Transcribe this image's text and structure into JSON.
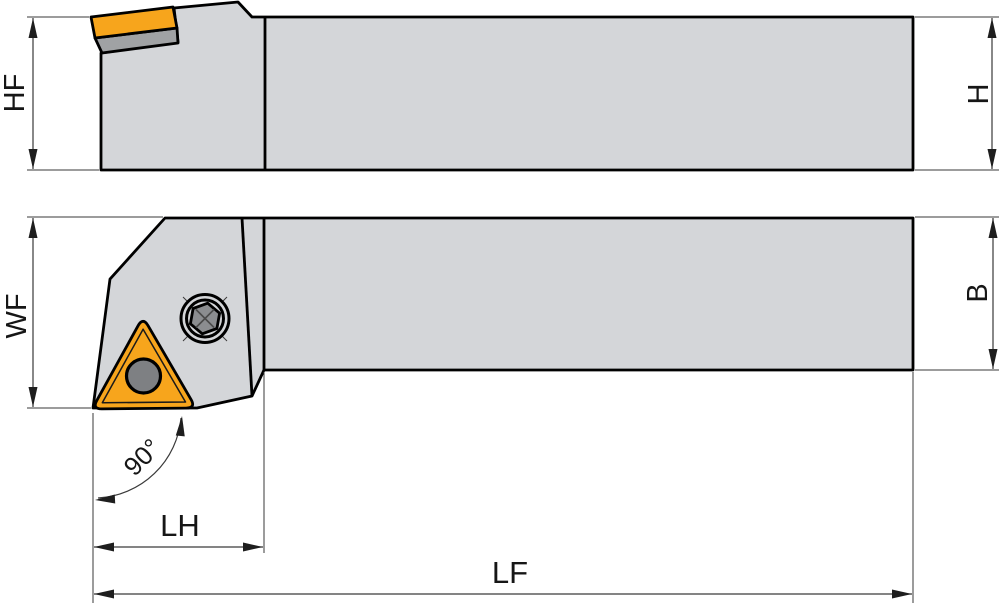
{
  "drawing": {
    "dimension_labels": {
      "hf": "HF",
      "h": "H",
      "wf": "WF",
      "b": "B",
      "lh": "LH",
      "lf": "LF"
    },
    "angle_annotation": {
      "label": "90°",
      "value_degrees": 90
    },
    "colors": {
      "insert_orange": "#F7A51C",
      "body_gray": "#D4D6D9",
      "wedge_gray": "#A0A2A4",
      "hole_gray": "#7E8083",
      "screw_gray": "#8B8D90",
      "outline_black": "#000000",
      "dimension_line_gray": "#3A3A3A",
      "background": "#FFFFFF"
    }
  }
}
